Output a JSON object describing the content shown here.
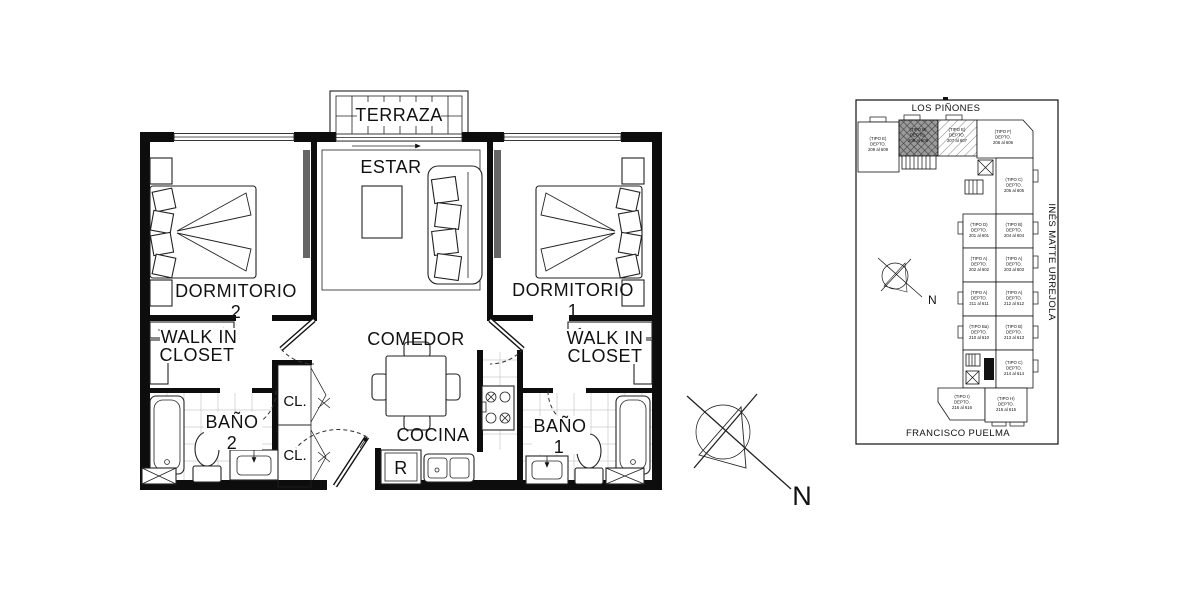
{
  "floor_plan": {
    "labels": {
      "terraza": "TERRAZA",
      "estar": "ESTAR",
      "dorm2_name": "DORMITORIO",
      "dorm2_num": "2",
      "dorm1_name": "DORMITORIO",
      "dorm1_num": "1",
      "wic_left_line1": "WALK IN",
      "wic_left_line2": "CLOSET",
      "wic_right_line1": "WALK IN",
      "wic_right_line2": "CLOSET",
      "comedor": "COMEDOR",
      "cocina": "COCINA",
      "bano2_name": "BAÑO",
      "bano2_num": "2",
      "bano1_name": "BAÑO",
      "bano1_num": "1",
      "cl_top": "CL.",
      "cl_bottom": "CL.",
      "refrigerator": "R"
    }
  },
  "compass": {
    "north": "N"
  },
  "key_plan": {
    "street_top": "LOS PIÑONES",
    "street_right": "INÉS MATTE URREJOLA",
    "street_bottom": "FRANCISCO PUELMA",
    "north": "N",
    "highlight_fill": "#9a9a9a",
    "units": [
      {
        "tipo": "(TIPO E)",
        "label": "DEPTO.",
        "range": "209 al 609"
      },
      {
        "tipo": "(TIPO B)",
        "label": "DEPTO.",
        "range": "208 al 608"
      },
      {
        "tipo": "(TIPO E)",
        "label": "DEPTO.",
        "range": "207 al 607"
      },
      {
        "tipo": "(TIPO F)",
        "label": "DEPTO.",
        "range": "206 al 606"
      },
      {
        "tipo": "(TIPO C)",
        "label": "DEPTO.",
        "range": "205 al 605"
      },
      {
        "tipo": "(TIPO D)",
        "label": "DEPTO.",
        "range": "201 al 601"
      },
      {
        "tipo": "(TIPO B)",
        "label": "DEPTO.",
        "range": "204 al 604"
      },
      {
        "tipo": "(TIPO A)",
        "label": "DEPTO.",
        "range": "202 al 602"
      },
      {
        "tipo": "(TIPO A)",
        "label": "DEPTO.",
        "range": "203 al 603"
      },
      {
        "tipo": "(TIPO A)",
        "label": "DEPTO.",
        "range": "211 al 611"
      },
      {
        "tipo": "(TIPO A)",
        "label": "DEPTO.",
        "range": "212 al 612"
      },
      {
        "tipo": "(TIPO Ba)",
        "label": "DEPTO.",
        "range": "210 al 610"
      },
      {
        "tipo": "(TIPO B)",
        "label": "DEPTO.",
        "range": "213 al 613"
      },
      {
        "tipo": "(TIPO C)",
        "label": "DEPTO.",
        "range": "214 al 614"
      },
      {
        "tipo": "(TIPO I)",
        "label": "DEPTO.",
        "range": "216 al 616"
      },
      {
        "tipo": "(TIPO H)",
        "label": "DEPTO.",
        "range": "215 al 615"
      }
    ]
  }
}
